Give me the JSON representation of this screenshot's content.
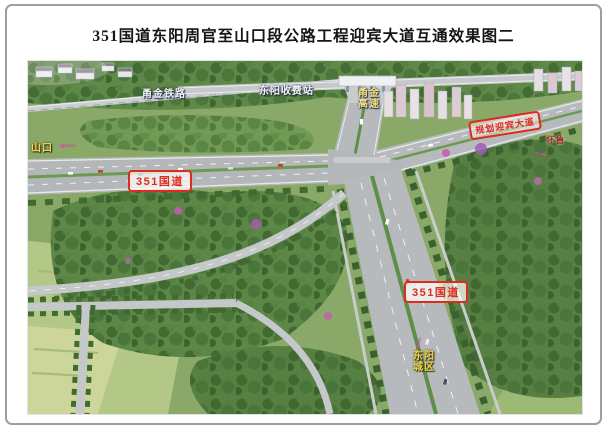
{
  "page": {
    "title": "351国道东阳周官至山口段公路工程迎宾大道互通效果图二"
  },
  "figure": {
    "labels": {
      "railway": "甬金铁路",
      "toll_station": "东阳收费站",
      "expressway": "甬金\n高速",
      "shankou": "山口",
      "huailu": "怀鲁",
      "city": "东阳\n城区",
      "g351_west": "351国道",
      "g351_south": "351国道",
      "planned_road": "规划迎宾大道"
    },
    "arrows": {
      "left": "←",
      "right": "→",
      "down": "↓"
    },
    "colors": {
      "badge_red": "#e02a1a",
      "arrow_pink": "#e957b2",
      "place_yellow": "#f2d44c",
      "label_white": "#f4f4f2",
      "huailu_maroon": "#9c3a26"
    }
  }
}
